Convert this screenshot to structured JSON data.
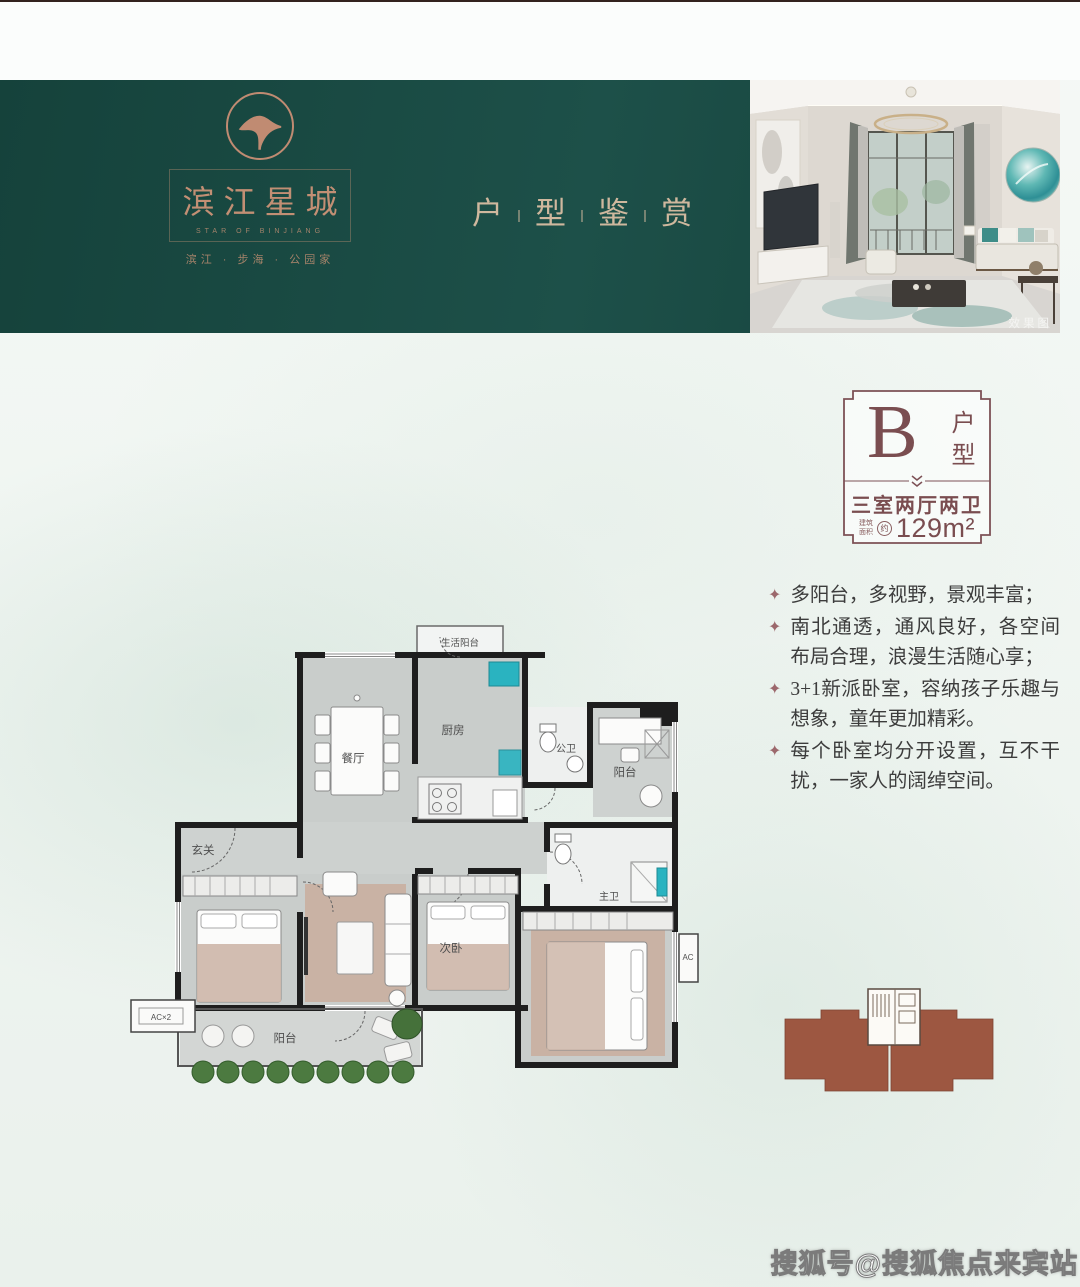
{
  "header": {
    "band_color": "#1a4a43",
    "logo": {
      "brand": "滨江星城",
      "brand_sub": "STAR OF BINJIANG",
      "tagline": "滨江 · 步海 · 公园家"
    },
    "title_chars": [
      "户",
      "型",
      "鉴",
      "赏"
    ],
    "photo_caption": "效果图"
  },
  "badge": {
    "letter": "B",
    "type_vertical": "户型",
    "layout": "三室两厅两卫",
    "area_small_1": "建筑",
    "area_small_2": "面积",
    "area_circle": "约",
    "area_value": "129m²"
  },
  "features": {
    "bullet": "✦",
    "items": [
      "多阳台，多视野，景观丰富；",
      "南北通透，通风良好，各空间布局合理，浪漫生活随心享；",
      "3+1新派卧室，容纳孩子乐趣与想象，童年更加精彩。",
      "每个卧室均分开设置，互不干扰，一家人的阔绰空间。"
    ]
  },
  "floorplan": {
    "labels": {
      "service_balcony": "生活阳台",
      "dining": "餐厅",
      "kitchen": "厨房",
      "guest_bath": "公卫",
      "balcony_top": "阳台",
      "entry": "玄关",
      "second_bedroom": "次卧",
      "master_bath": "主卫",
      "balcony_bottom": "阳台",
      "ac_left": "AC×2",
      "ac_right": "AC"
    }
  },
  "watermark": "搜狐号@搜狐焦点来宾站",
  "colors": {
    "teal_band": "#1a4a43",
    "copper": "#c28f74",
    "maroon": "#7a4d50",
    "footprint_brown": "#9d5741",
    "plan_teal_accent": "#2ab3c0"
  }
}
